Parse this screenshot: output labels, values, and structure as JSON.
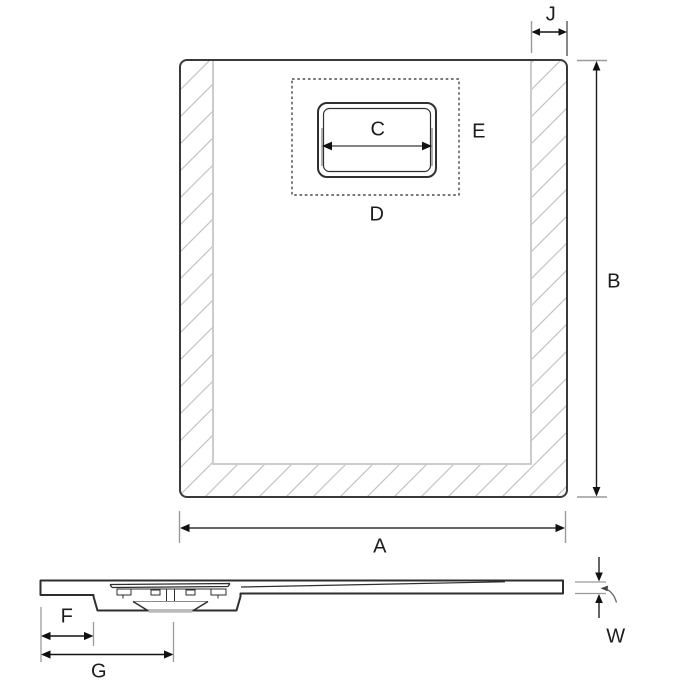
{
  "diagram": {
    "type": "technical-drawing",
    "subject": "shower tray dimension diagram - plan view and section view",
    "views": {
      "plan": {
        "labels": {
          "edge_band_width": "J",
          "overall_depth": "B",
          "drain_cover_width": "C",
          "drain_zone_bottom": "D",
          "drain_zone_right": "E",
          "overall_width": "A"
        }
      },
      "section": {
        "labels": {
          "edge_to_drain_housing": "F",
          "edge_to_drain_centre": "G",
          "edge_thickness": "W"
        }
      }
    },
    "colors": {
      "outline_dark": "#3a3a3a",
      "dimension_line": "#1a1a1a",
      "extension_line_gray": "#9a9a9a",
      "inner_boundary_gray": "#cccccc",
      "hatch_gray": "#c3c3c3",
      "background": "#ffffff"
    }
  }
}
